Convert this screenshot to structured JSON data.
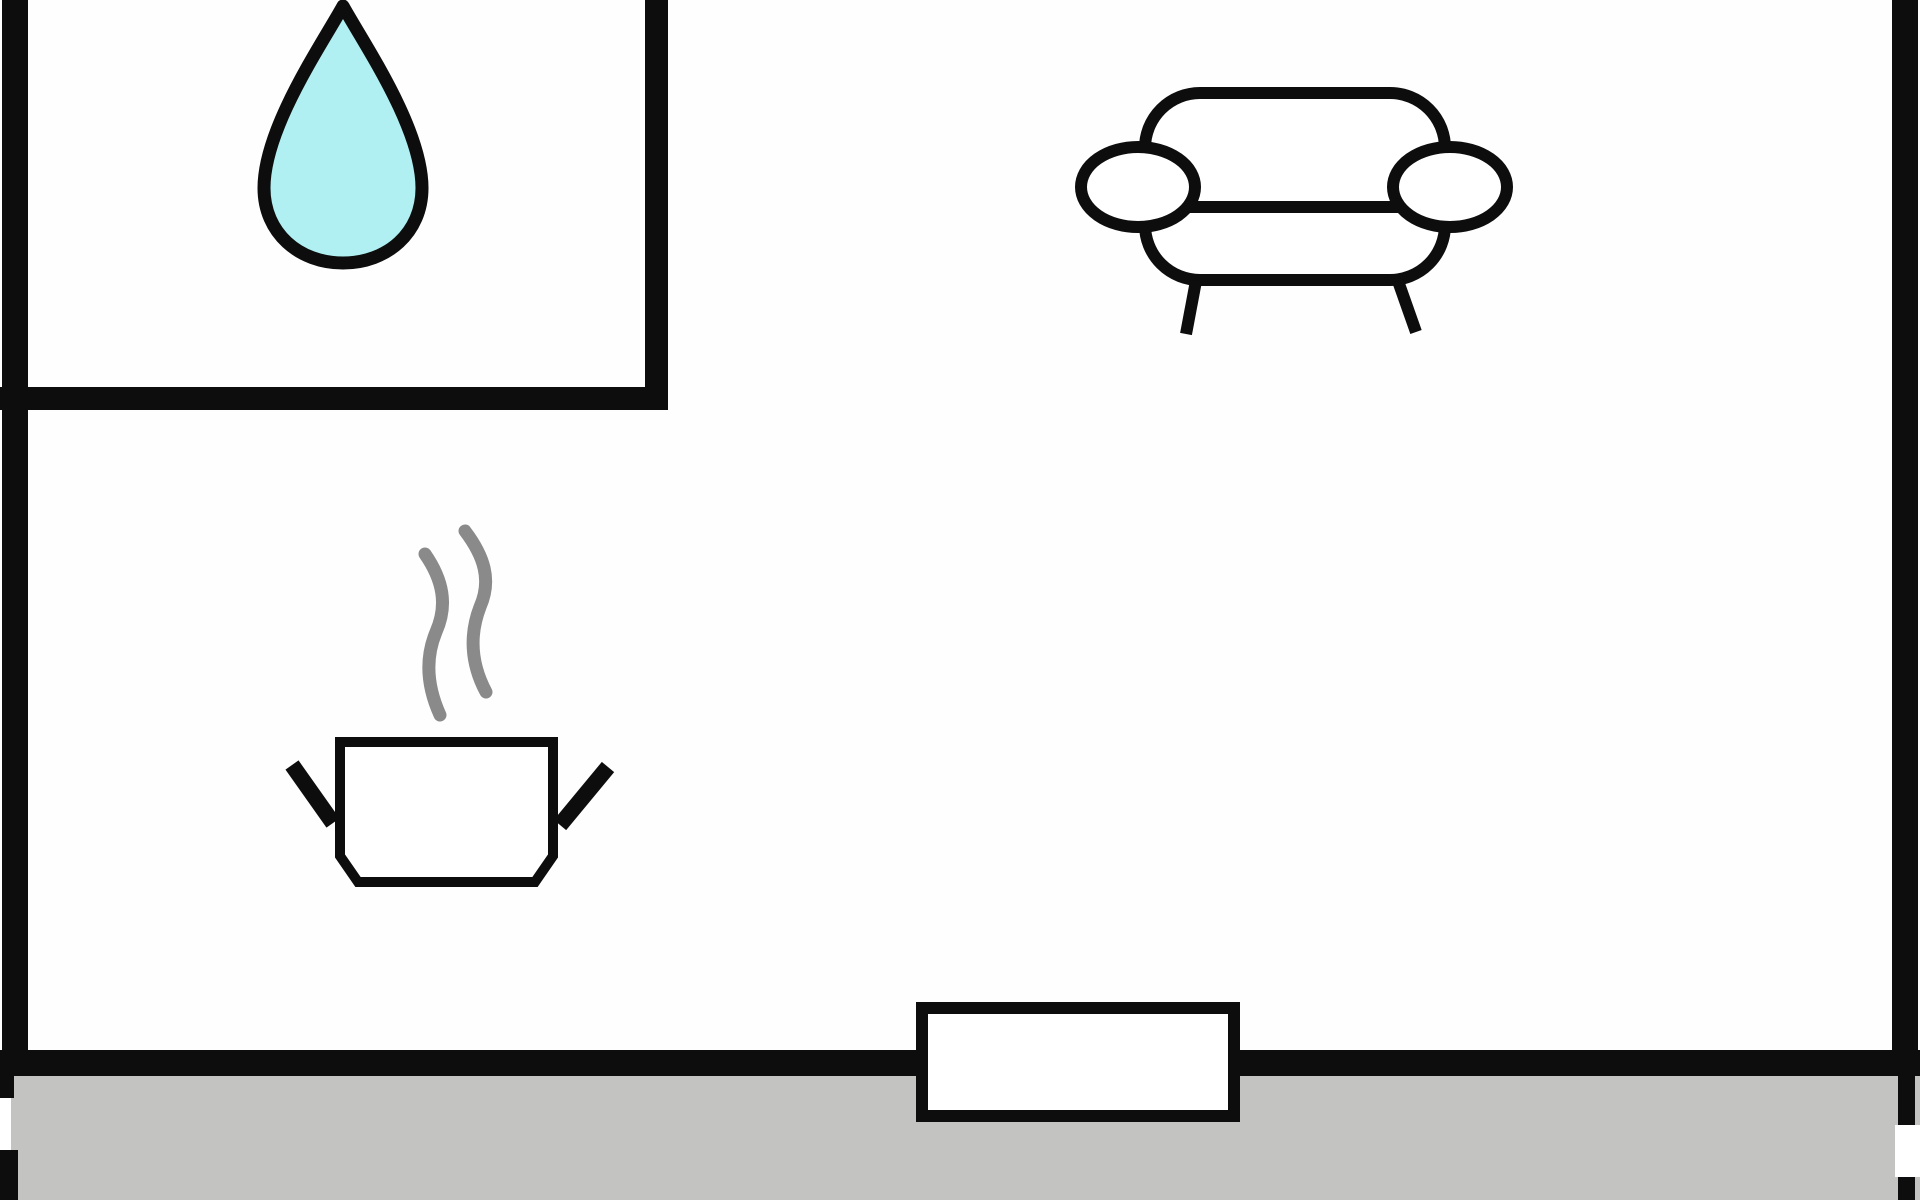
{
  "colors": {
    "background": "#fefefe",
    "wall": "#0d0d0d",
    "ground": "#c3c4c1",
    "door_fill": "#ffffff",
    "furniture_fill": "#ffffff",
    "gap_fill": "#ffffff",
    "water_drop_fill": "#b0f0f2",
    "steam": "#8a8a8a"
  },
  "icons": [
    {
      "name": "water-drop-icon"
    },
    {
      "name": "sofa-icon"
    },
    {
      "name": "cooking-pot-icon"
    },
    {
      "name": "steam-icon"
    },
    {
      "name": "door-icon"
    }
  ]
}
